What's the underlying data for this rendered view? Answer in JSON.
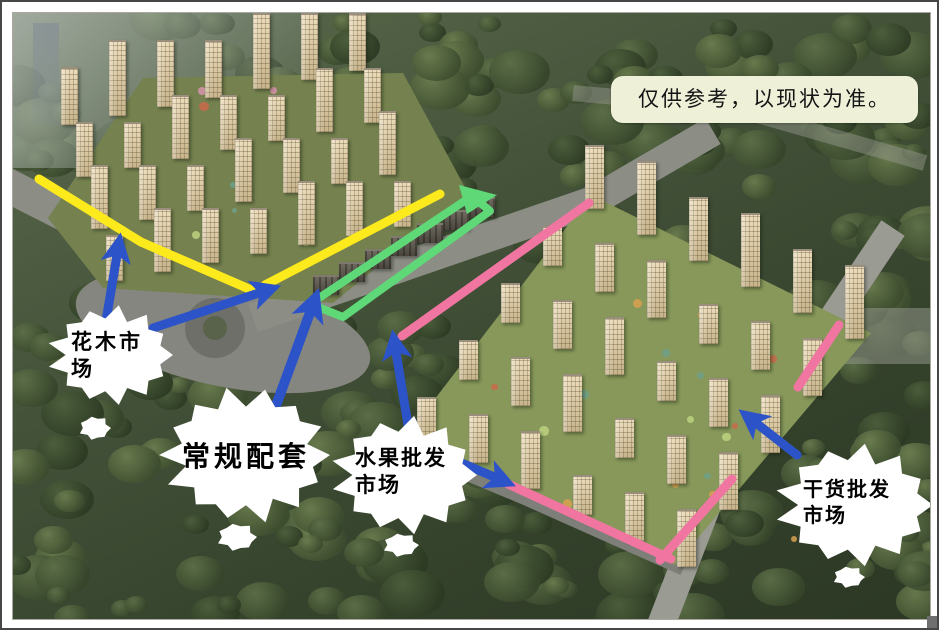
{
  "note": {
    "text": "仅供参考，以现状为准。"
  },
  "callouts": {
    "flower_market": "花木市场",
    "regular_facilities": "常规配套",
    "fruit_market": "水果批发市场",
    "dry_goods_market": "干货批发市场"
  },
  "colors": {
    "route_yellow": "#fdea1c",
    "route_green": "#5fd878",
    "route_pink": "#f075a0",
    "arrow_blue": "#2d53c8",
    "note_bg": "#eef0d8"
  }
}
